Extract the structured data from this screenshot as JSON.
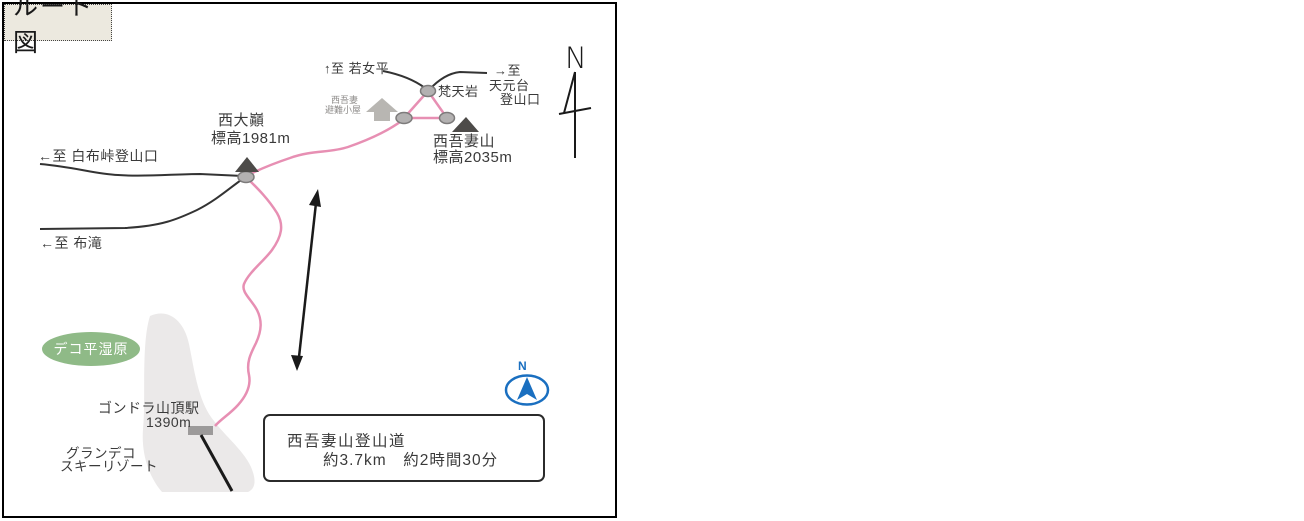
{
  "map": {
    "title": "ルート図",
    "north_arrow": {
      "label": "N"
    },
    "compass_icon": {
      "label": "N"
    },
    "destinations": {
      "wakajotaira": "↑至 若女平",
      "tengendai_line1": "→至",
      "tengendai_line2": "天元台",
      "tengendai_line3": "登山口",
      "shirabu_pass": "←至 白布峠登山口",
      "nunotaki": "←至 布滝"
    },
    "points": {
      "bonteniwa": "梵天岩",
      "hut_line1": "西吾妻",
      "hut_line2": "避難小屋",
      "nishidaiten_name": "西大巓",
      "nishidaiten_elevation": "標高1981m",
      "nishiazuma_name": "西吾妻山",
      "nishiazuma_elevation": "標高2035m",
      "dekodaira_wetland": "デコ平湿原",
      "gondola_station_name": "ゴンドラ山頂駅",
      "gondola_station_elevation": "1390m",
      "grandeco_line1": "グランデコ",
      "grandeco_line2": "スキーリゾート"
    },
    "info_box": {
      "trail_name": "西吾妻山登山道",
      "distance_time": "約3.7km　約2時間30分"
    },
    "colors": {
      "route_pink": "#e78fb3",
      "road_black": "#333333",
      "wetland_green": "#8fba87",
      "compass_blue": "#1a6fc0",
      "ski_area_gray": "#ebe9e9",
      "title_bg": "#ece9df"
    }
  }
}
